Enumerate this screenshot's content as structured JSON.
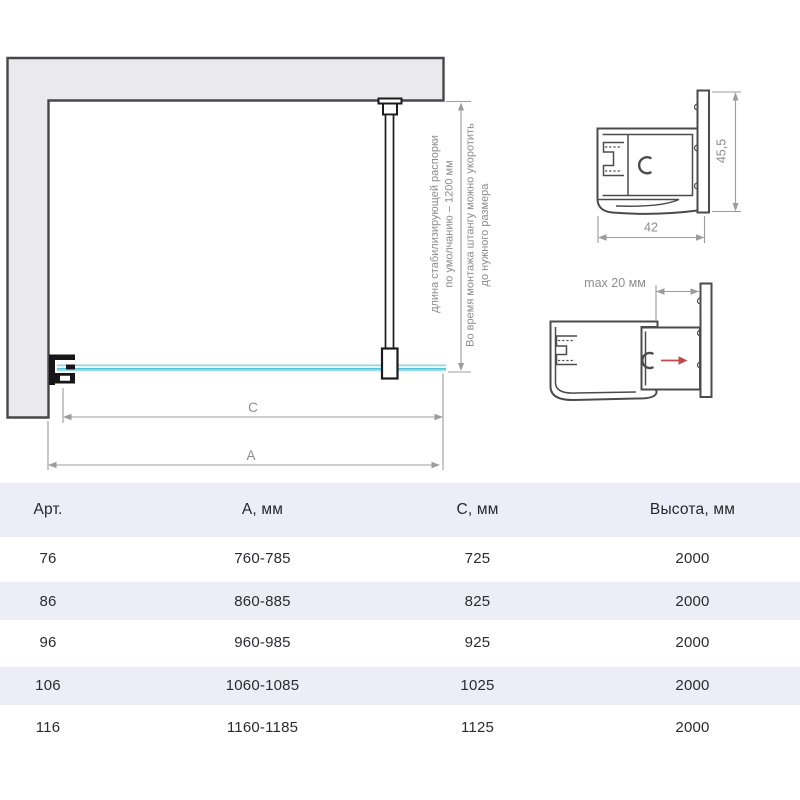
{
  "drawing": {
    "annotations": {
      "strut_note_line1": "длина стабилизирующей распорки",
      "strut_note_line2": "по умолчанию – 1200 мм",
      "install_note_line1": "Во время монтажа штангу можно укоротить",
      "install_note_line2": "до нужного размера",
      "dim_c": "C",
      "dim_a": "A"
    },
    "profile_top": {
      "height_label": "45,5",
      "width_label": "42"
    },
    "profile_bottom": {
      "max_label": "max 20 мм"
    },
    "colors": {
      "wall_fill": "#eaeaec",
      "outline_dark": "#1b1b1d",
      "profile_outline": "#4b4b4e",
      "dimension_line": "#9c9c9c",
      "annotation_text": "#8d8d8d",
      "glass_cyan": "#50c5da",
      "red_arrow": "#c2494f",
      "table_row_alt": "#ecedf7"
    }
  },
  "table": {
    "columns": [
      "Арт.",
      "А, мм",
      "С, мм",
      "Высота, мм"
    ],
    "rows": [
      [
        "76",
        "760-785",
        "725",
        "2000"
      ],
      [
        "86",
        "860-885",
        "825",
        "2000"
      ],
      [
        "96",
        "960-985",
        "925",
        "2000"
      ],
      [
        "106",
        "1060-1085",
        "1025",
        "2000"
      ],
      [
        "116",
        "1160-1185",
        "1125",
        "2000"
      ]
    ]
  }
}
